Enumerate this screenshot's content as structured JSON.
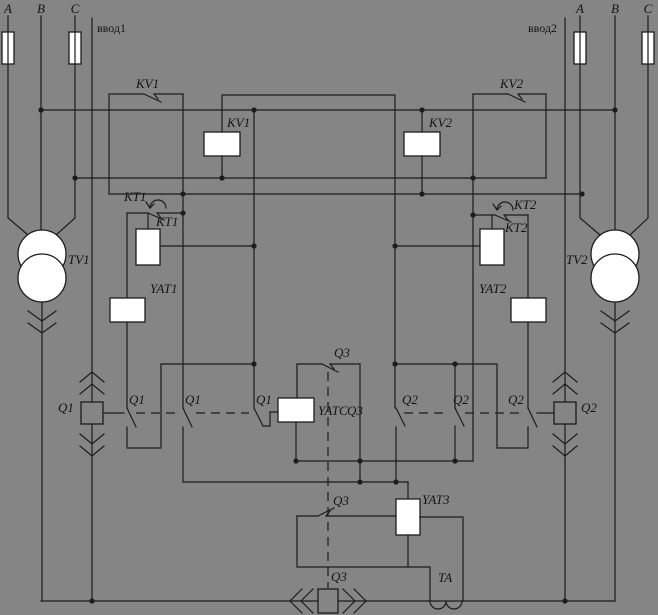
{
  "colors": {
    "background": "#858585",
    "line": "#1c1c1c",
    "box_fill": "#ffffff"
  },
  "left_feeder": {
    "label": "ввод1",
    "phase_a": "A",
    "phase_b": "B",
    "phase_c": "C",
    "transformer": "TV1",
    "breaker": "Q1"
  },
  "right_feeder": {
    "label": "ввод2",
    "phase_a": "A",
    "phase_b": "B",
    "phase_c": "C",
    "transformer": "TV2",
    "breaker": "Q2"
  },
  "relays": {
    "kv1": "KV1",
    "kv2": "KV2",
    "kt1": "KT1",
    "kt2": "KT2"
  },
  "trip_coils": {
    "yat1": "YAT1",
    "yat2": "YAT2",
    "yatc": "YATC",
    "yat3": "YAT3"
  },
  "tie": {
    "breaker": "Q3",
    "contact": "Q3",
    "link": "Q3"
  },
  "current_transformer": {
    "label": "TA"
  }
}
